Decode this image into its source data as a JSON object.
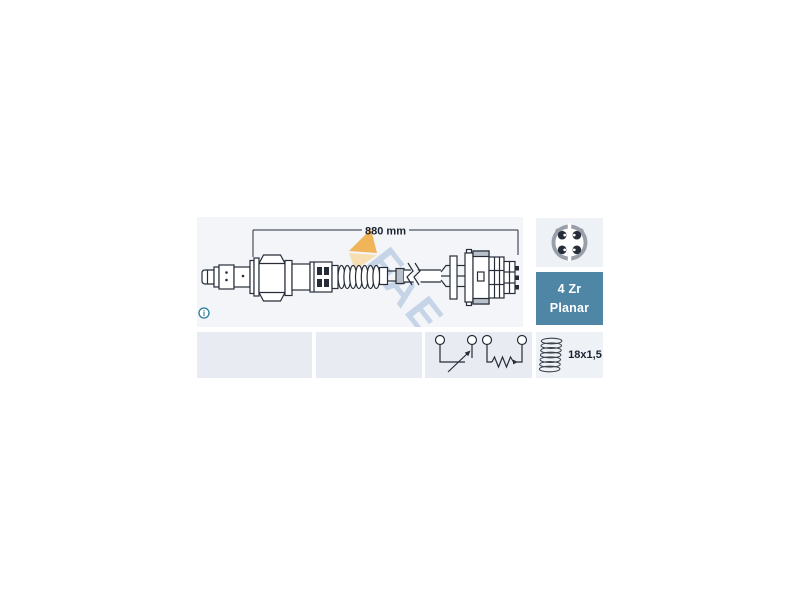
{
  "drawing": {
    "dimension_label": "880 mm",
    "info_glyph": "i"
  },
  "badge": {
    "line1": "4 Zr",
    "line2": "Planar"
  },
  "thread": {
    "label": "18x1,5"
  },
  "watermark": {
    "text": "FAE"
  },
  "icons": {
    "connector_face": "4-pin-round-connector-icon",
    "thread": "thread-coil-icon",
    "schematic": "sensor-cell-and-heater-circuit-icon",
    "info": "info-icon",
    "break_symbol": "cable-shortened-break-icon"
  },
  "colors": {
    "badge-blue": "#4f86a6",
    "drawing-bg": "#f3f5f9",
    "cell-bg": "#e8ecf2",
    "icon-panel-bg": "#eef1f6",
    "line-color": "#262d39",
    "text-dark": "#1a2130",
    "teal": "#2a7d9d",
    "ring-gray": "#989fa8",
    "part-gray": "#b9c0c9",
    "wm-orange": "#efa93d",
    "wm-yellow": "#f7daa6",
    "wm-blue": "rgba(135,168,208,0.42)"
  }
}
